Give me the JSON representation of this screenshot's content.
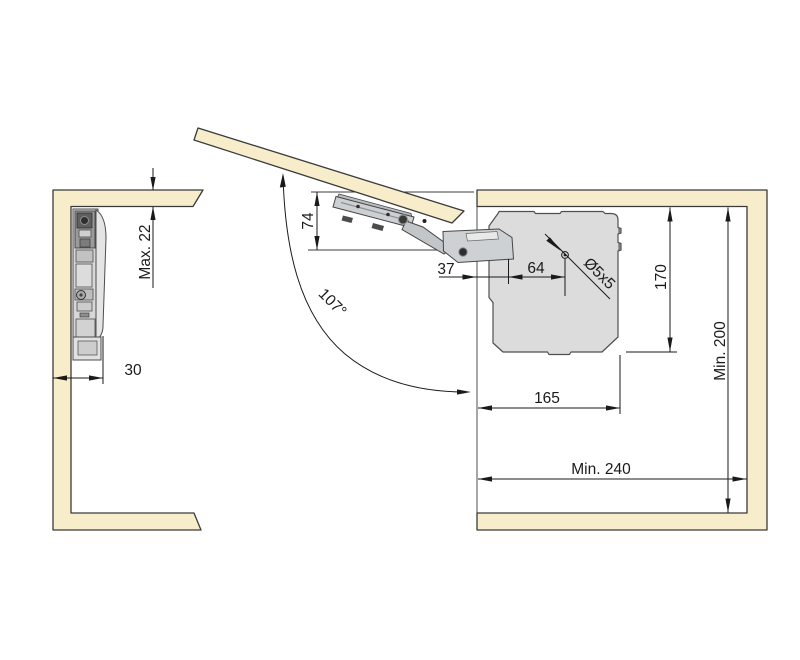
{
  "diagram": {
    "description": "Installation drawing of a lift-up flap mechanism inside a cabinet",
    "colors": {
      "panel_fill": "#F7EDCB",
      "panel_stroke": "#3A3A3A",
      "mechanism_fill": "#DCDCDC",
      "mechanism_stroke": "#4F4F4F",
      "dimension_color": "#1A1A1A",
      "background": "#FFFFFF"
    },
    "dimensions": {
      "panel_thickness": "Max. 22",
      "side_offset": "30",
      "arm_height": "74",
      "front_to_first_hole": "37",
      "hole_spacing": "64",
      "screw_spec": "Ø5x5",
      "body_height": "170",
      "min_depth": "Min. 200",
      "body_length": "165",
      "min_inner_width": "Min. 240",
      "opening_angle": "107°"
    }
  }
}
